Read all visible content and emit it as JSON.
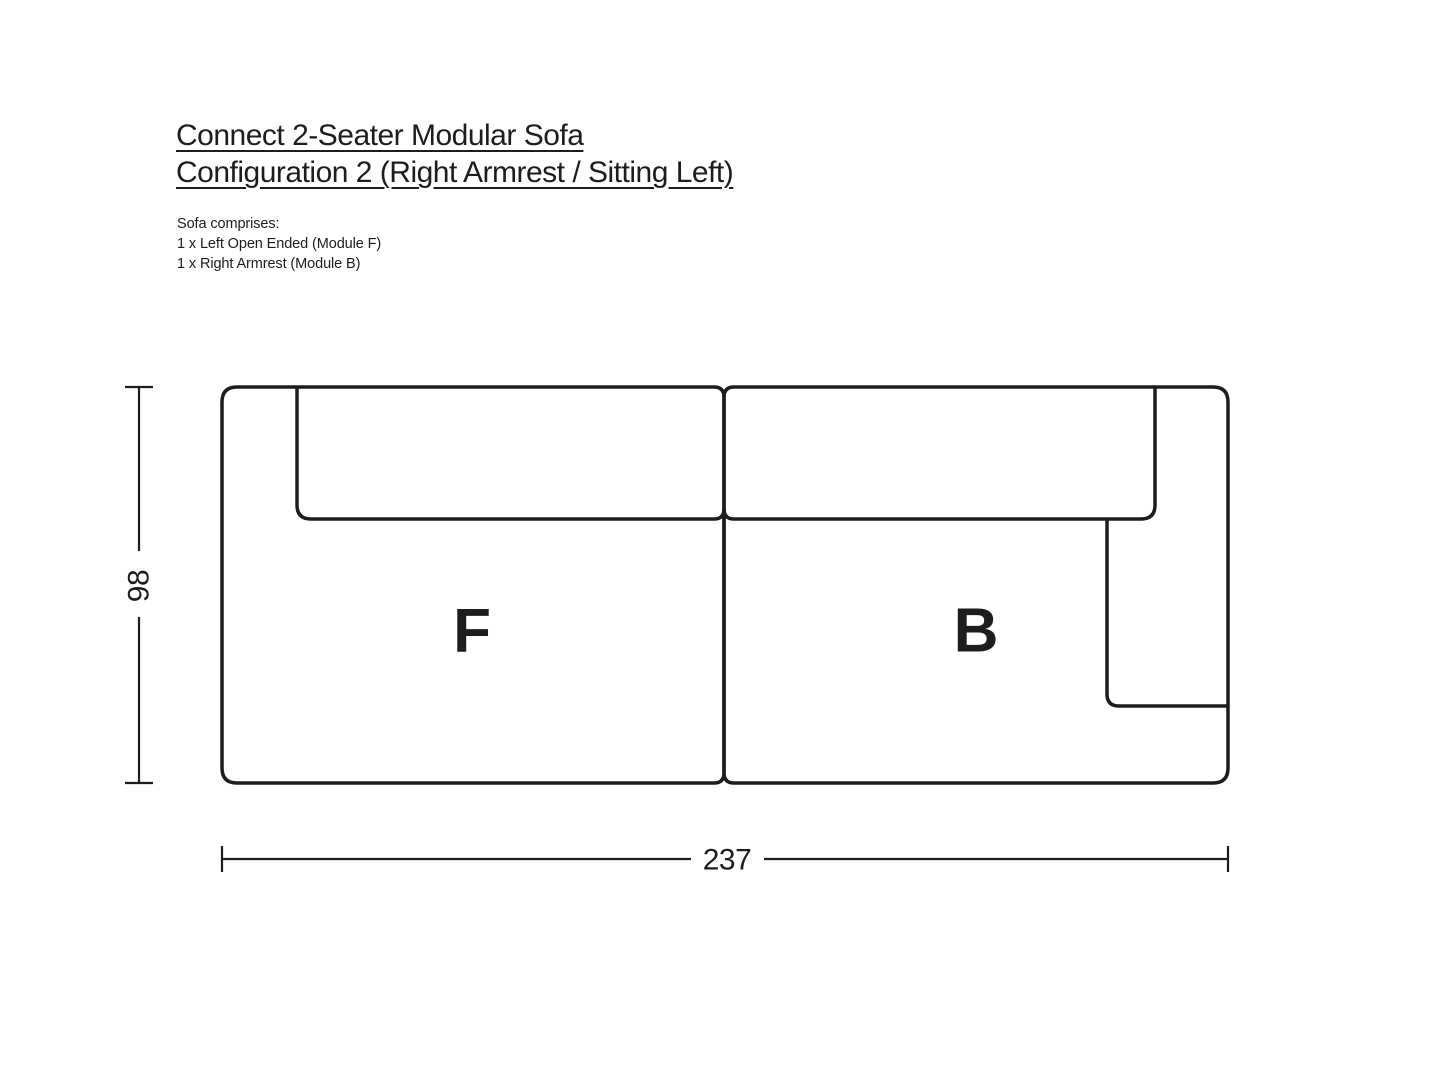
{
  "page": {
    "bg": "#ffffff",
    "ink": "#1d1d1b"
  },
  "header": {
    "title_line1": "Connect 2-Seater Modular Sofa",
    "title_line2": "Configuration 2 (Right Armrest / Sitting Left)"
  },
  "comprises": {
    "intro": "Sofa comprises:",
    "items": [
      "1 x Left Open Ended (Module F)",
      "1 x Right Armrest (Module B)"
    ]
  },
  "diagram": {
    "module_left_label": "F",
    "module_right_label": "B",
    "depth_cm": "98",
    "width_cm": "237"
  }
}
